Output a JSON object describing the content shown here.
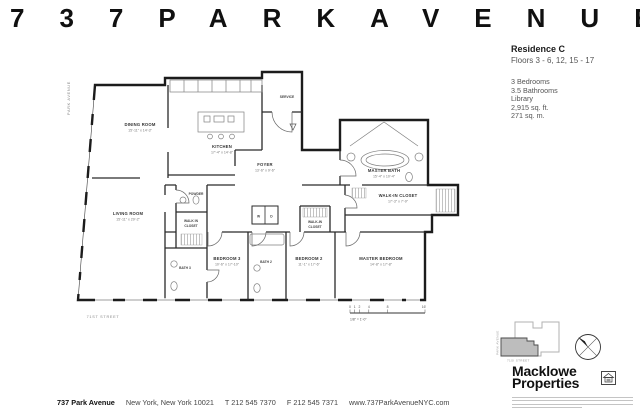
{
  "header": {
    "title": "737PARKAVENUE"
  },
  "info": {
    "residence": "Residence C",
    "floors": "Floors 3 - 6, 12, 15 - 17",
    "details": [
      "3 Bedrooms",
      "3.5 Bathrooms",
      "Library",
      "2,915 sq. ft.",
      "271 sq. m."
    ]
  },
  "plan": {
    "avenue_label": "PARK AVENUE",
    "street_label": "71ST STREET",
    "rooms": {
      "dining_name": "DINING ROOM",
      "dining_dims": "15'-11\" x 14'-3\"",
      "kitchen_name": "KITCHEN",
      "kitchen_dims": "17'-4\" x 14'-8\"",
      "service": "SERVICE",
      "foyer_name": "FOYER",
      "foyer_dims": "13'-6\" x 9'-6\"",
      "living_name": "LIVING ROOM",
      "living_dims": "15'-11\" x 29'-2\"",
      "powder": "POWDER",
      "wic3_l1": "WALK IN",
      "wic3_l2": "CLOSET",
      "bath3": "BATH 3",
      "bedroom3_name": "BEDROOM 3",
      "bedroom3_dims": "10'-6\" x 17'-10\"",
      "bath2": "BATH 2",
      "bedroom2_name": "BEDROOM 2",
      "bedroom2_dims": "11'-1\" x 17'-6\"",
      "wic2_l1": "WALK-IN",
      "wic2_l2": "CLOSET",
      "master_bed_name": "MASTER BEDROOM",
      "master_bed_dims": "14'-8\" x 17'-8\"",
      "master_bath_name": "MASTER BATH",
      "master_bath_dims": "15'-4\" x 10'-4\"",
      "master_wic_name": "WALK-IN CLOSET",
      "master_wic_dims": "17'-3\" x 7'-9\"",
      "washer": "W",
      "dryer": "D"
    },
    "scale": {
      "n0": "0",
      "n1": "1",
      "n2": "2",
      "n4": "4",
      "n8": "8",
      "n16": "16'",
      "ratio": "1/8\" = 1'-0\""
    }
  },
  "keyplan": {
    "avenue_label": "PARK AVENUE",
    "street_label": "71SI STREET"
  },
  "brand": {
    "line1": "Macklowe",
    "line2": "Properties"
  },
  "footer": {
    "name": "737 Park Avenue",
    "address": "New York, New York 10021",
    "phone": "T 212 545 7370",
    "fax": "F 212 545 7371",
    "website": "www.737ParkAvenueNYC.com"
  }
}
